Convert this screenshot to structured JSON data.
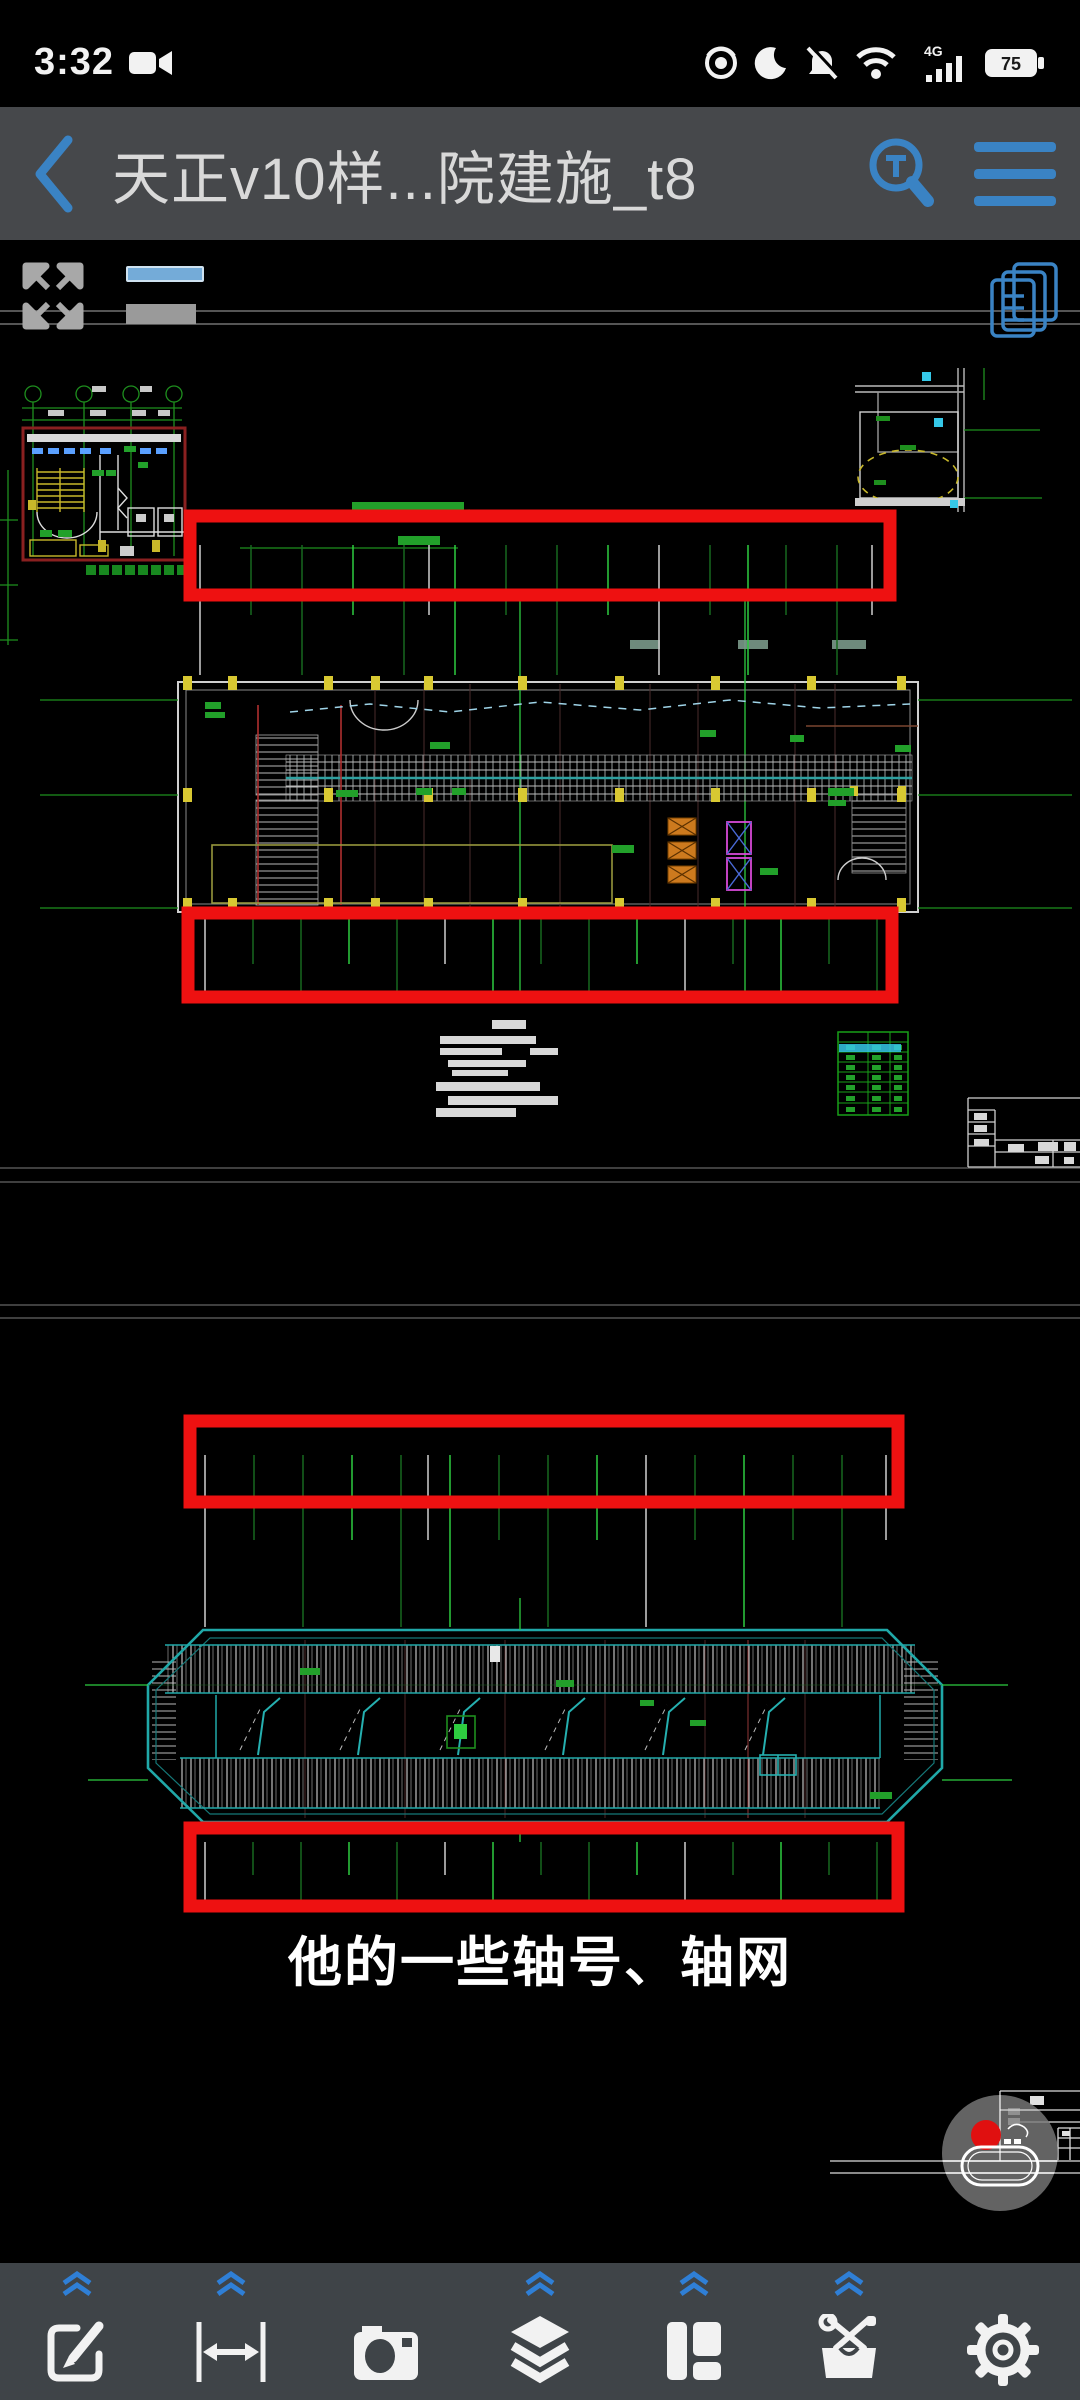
{
  "status_bar": {
    "time": "3:32",
    "network_label": "4G",
    "battery_percent": "75"
  },
  "title_bar": {
    "title": "天正v10样...院建施_t8"
  },
  "viewer": {
    "caption": "他的一些轴号、轴网"
  },
  "colors": {
    "accent_blue": "#3a83c4",
    "highlight_red": "#ee1111",
    "cad_green_bright": "#2ecc40",
    "cad_green_dim": "#17691f",
    "cad_teal": "#1fa7a7",
    "cad_yellow": "#d2c235",
    "titlebar_bg": "#46484b",
    "toolbar_bg": "#3f4448"
  },
  "highlight_boxes": [
    {
      "x": 190,
      "y": 516,
      "w": 700,
      "h": 79
    },
    {
      "x": 188,
      "y": 913,
      "w": 704,
      "h": 84
    },
    {
      "x": 190,
      "y": 1421,
      "w": 708,
      "h": 81
    },
    {
      "x": 190,
      "y": 1828,
      "w": 708,
      "h": 78
    }
  ],
  "sheet_separator_lines": [
    311,
    324,
    1168,
    1182,
    1305,
    1318
  ],
  "axis_tick_groups": [
    {
      "y": 545,
      "long": 130,
      "short": 70,
      "xs": [
        200,
        251,
        302,
        353,
        404,
        429,
        455,
        506,
        557,
        608,
        659,
        710,
        748,
        786,
        837,
        872
      ]
    },
    {
      "y": 918,
      "long": 76,
      "short": 46,
      "xs": [
        205,
        253,
        301,
        349,
        397,
        445,
        493,
        541,
        589,
        637,
        685,
        733,
        781,
        829,
        877
      ]
    },
    {
      "y": 1455,
      "long": 172,
      "short": 85,
      "xs": [
        205,
        254,
        303,
        352,
        401,
        428,
        450,
        499,
        548,
        597,
        646,
        695,
        744,
        793,
        842,
        886
      ]
    },
    {
      "y": 1842,
      "long": 58,
      "short": 33,
      "xs": [
        205,
        253,
        301,
        349,
        397,
        445,
        493,
        541,
        589,
        637,
        685,
        733,
        781,
        829,
        877
      ]
    }
  ],
  "toolbar": {
    "items": [
      {
        "id": "edit",
        "icon": "edit-icon",
        "chevron": true
      },
      {
        "id": "measure",
        "icon": "measure-icon",
        "chevron": true
      },
      {
        "id": "camera",
        "icon": "camera-icon",
        "chevron": false
      },
      {
        "id": "layers",
        "icon": "layers-icon",
        "chevron": true
      },
      {
        "id": "layout",
        "icon": "layout-icon",
        "chevron": true
      },
      {
        "id": "toolbox",
        "icon": "toolbox-icon",
        "chevron": true
      },
      {
        "id": "settings",
        "icon": "gear-icon",
        "chevron": false
      }
    ]
  }
}
